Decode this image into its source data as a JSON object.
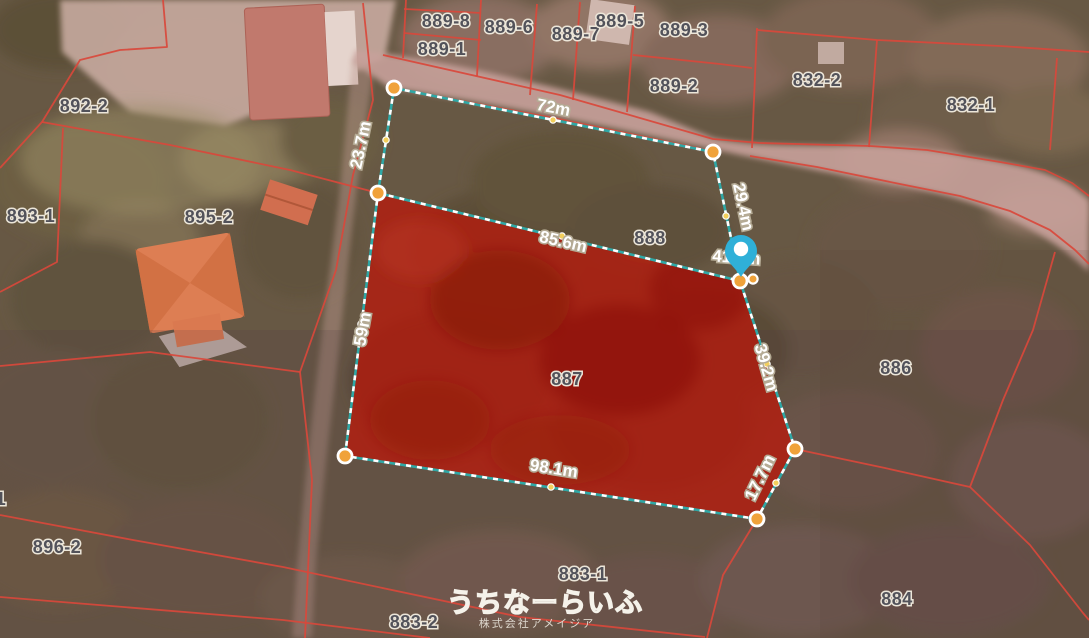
{
  "watermark": {
    "brand": "うちなーらいふ",
    "company": "株式会社アメイジア"
  },
  "parcels": {
    "n889_8": "889-8",
    "n889_1": "889-1",
    "n889_6": "889-6",
    "n889_7": "889-7",
    "n889_5": "889-5",
    "n889_3": "889-3",
    "n889_2": "889-2",
    "n832_2": "832-2",
    "n832_1": "832-1",
    "n892_2": "892-2",
    "n893_1": "893-1",
    "n895_2": "895-2",
    "n888": "888",
    "n887": "887",
    "n886": "886",
    "n896_2": "896-2",
    "n883_1": "883-1",
    "n883_2": "883-2",
    "n884": "884",
    "n_partial_left": "1"
  },
  "highlight": {
    "parcel": "887",
    "fill_color": "#b7190c",
    "boundary_teal": "#2fa8a6",
    "boundary_dash": "#ffffff",
    "vertex_color": "#f0a23a"
  },
  "measurements": {
    "top_edge": "72m",
    "upper_left_edge": "23.7m",
    "upper_right_edge": "29.4m",
    "pin_edge": "41.9m",
    "divider_edge": "85.6m",
    "left_edge": "59m",
    "right_edge": "39.2m",
    "lower_right_edge": "17.7m",
    "bottom_edge": "98.1m"
  },
  "colors": {
    "cadastral_line": "#d9483b",
    "pin": "#2fb0d8",
    "parcel_label_text": "#52525a",
    "measure_text": "#ffffff"
  }
}
